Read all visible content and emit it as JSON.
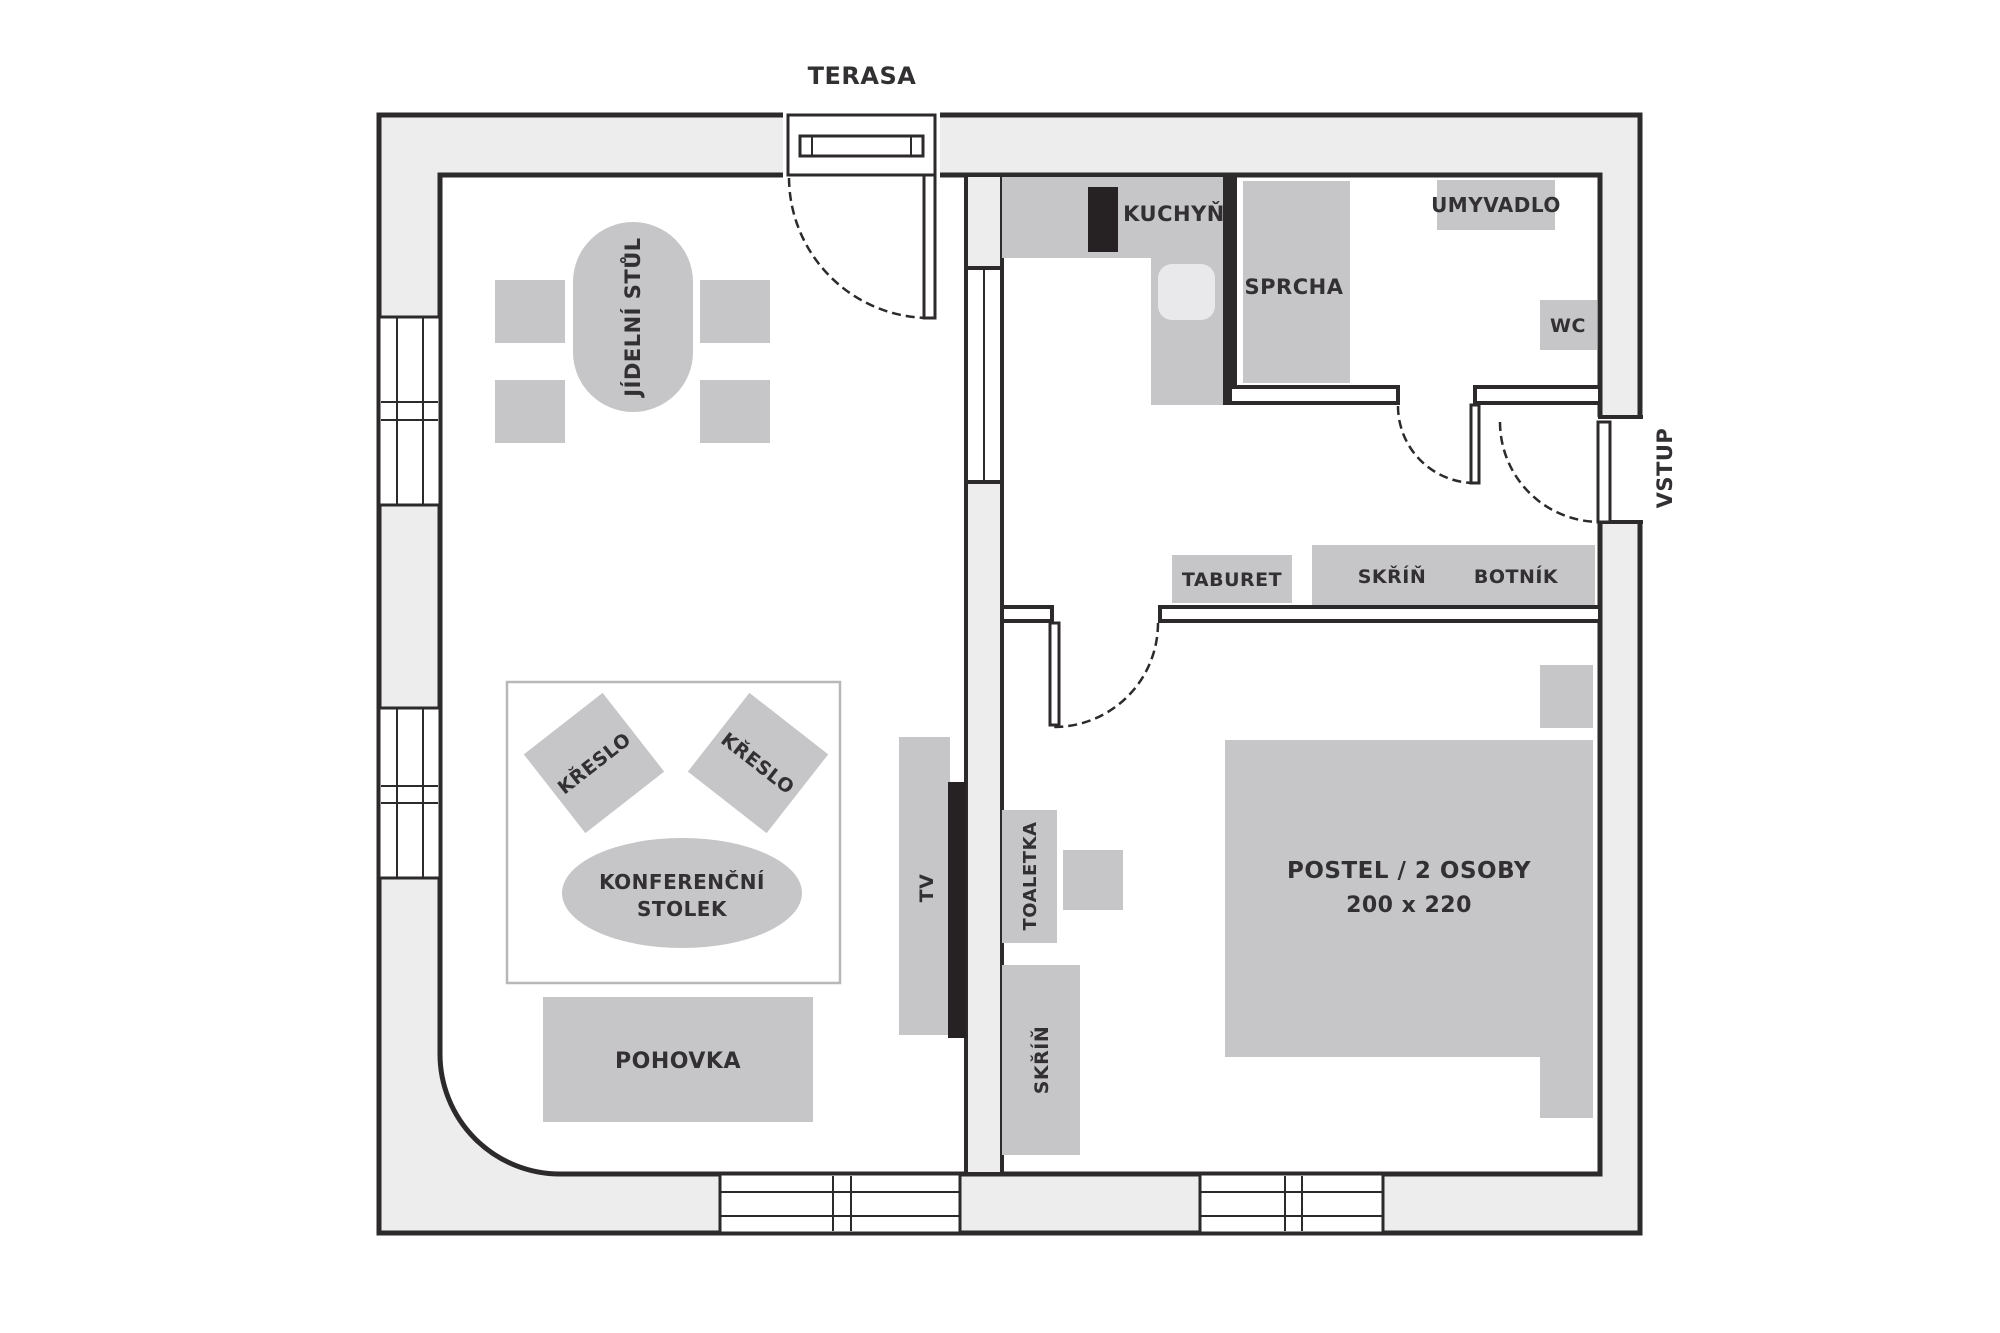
{
  "colors": {
    "background": "#ffffff",
    "wall_fill": "#eeedee",
    "line": "#2c2a2b",
    "furniture": "#c6c5c7",
    "furniture_light": "#e9e8ea",
    "appliance_dark": "#262223",
    "text": "#323032",
    "rug_outline": "#b8b7b9"
  },
  "labels": {
    "terrace": "TERASA",
    "entrance": "VSTUP",
    "kitchen": "KUCHYŇ",
    "shower": "SPRCHA",
    "washbasin": "UMYVADLO",
    "wc": "WC",
    "stool_hall": "TABURET",
    "wardrobe_hall": "SKŘÍŇ",
    "shoe_rack": "BOTNÍK",
    "dining_table": "JÍDELNÍ STŮL",
    "armchair": "KŘESLO",
    "coffee_table_1": "KONFERENČNÍ",
    "coffee_table_2": "STOLEK",
    "tv": "TV",
    "sofa": "POHOVKA",
    "dressing_table": "TOALETKA",
    "wardrobe_bedroom": "SKŘÍŇ",
    "bed_1": "POSTEL / 2 OSOBY",
    "bed_2": "200 x 220"
  }
}
